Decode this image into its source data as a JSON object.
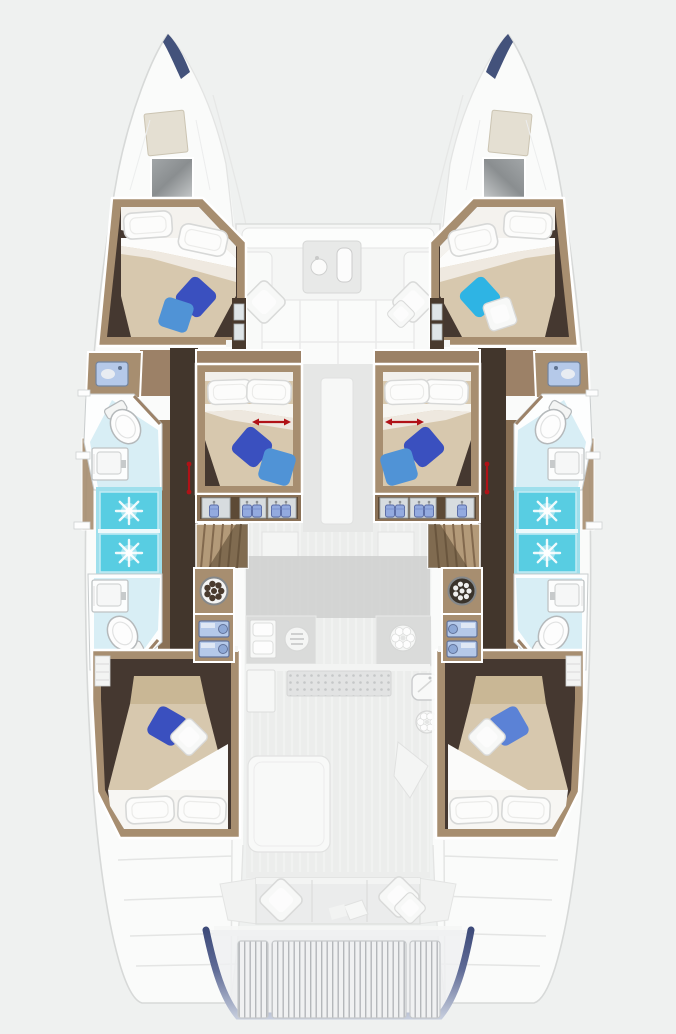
{
  "page": {
    "title": "Catamaran lower-deck floor plan",
    "background": "#eff1f0"
  },
  "colors": {
    "background": "#eff1f0",
    "hull-white": "#fbfcfb",
    "hull-outline": "#d7d9d8",
    "wood": "#a78e70",
    "wood-dark": "#8a7156",
    "cabin-floor": "#453830",
    "bed-duvet": "#d7c8ae",
    "bed-sheet": "#fcfcfb",
    "shower": "#58cde2",
    "shower-frame": "#9fdfec",
    "bath-floor": "#d8eef5",
    "fixture-white": "#fdfdfd",
    "arrow-red": "#b01217",
    "pillow-navy": "#3a50bf",
    "pillow-blue": "#5093d6",
    "pillow-cyan": "#2eb4e4",
    "pillow-periwinkle": "#5b82d6",
    "hanger-blue": "#93aadf",
    "appliance-blue": "#b5c9e9",
    "deck-faded": "#ebeceb",
    "deck-dark": "#d2d3d2",
    "counter-grey": "#dadbda",
    "bench-grey": "#ebecec",
    "transom-navy": "#3e4b7a",
    "hatch-grey": "#8a8e90",
    "hatch-beige": "#e4dfd2"
  },
  "vessel": {
    "type": "sailing-catamaran-floor-plan",
    "deck_shown": "lower-deck-highlighted-over-faded-main-deck",
    "cabins": [
      {
        "id": "port-forward-cabin",
        "features": [
          "double-bed",
          "two-white-pillows",
          "navy-accent-pillow",
          "blue-accent-pillow",
          "overhead-hatches"
        ]
      },
      {
        "id": "starboard-forward-cabin",
        "features": [
          "double-bed",
          "two-white-pillows",
          "cyan-accent-pillow",
          "white-accent-pillow",
          "overhead-hatches"
        ]
      },
      {
        "id": "port-center-cabin",
        "features": [
          "double-bed",
          "red-slide-arrow",
          "navy-accent-pillow",
          "blue-accent-pillow",
          "wardrobe-three-doors",
          "red-door-slide-arrow"
        ]
      },
      {
        "id": "starboard-center-cabin",
        "features": [
          "double-bed",
          "red-slide-arrow",
          "navy-accent-pillow",
          "blue-accent-pillow",
          "wardrobe-three-doors",
          "red-door-slide-arrow"
        ]
      },
      {
        "id": "port-aft-cabin",
        "features": [
          "double-bed",
          "two-white-pillows",
          "navy-accent-pillow",
          "white-accent-pillow",
          "shelf-unit"
        ]
      },
      {
        "id": "starboard-aft-cabin",
        "features": [
          "double-bed",
          "two-white-pillows",
          "periwinkle-accent-pillow",
          "white-accent-pillow",
          "shelf-unit"
        ]
      }
    ],
    "bathrooms": [
      {
        "id": "port-forward-bathroom",
        "fixtures": [
          "toilet",
          "washbasin",
          "shower-with-drain"
        ]
      },
      {
        "id": "port-aft-bathroom",
        "fixtures": [
          "washbasin",
          "toilet",
          "shower-with-drain"
        ]
      },
      {
        "id": "starboard-forward-bathroom",
        "fixtures": [
          "toilet",
          "washbasin",
          "shower-with-drain"
        ]
      },
      {
        "id": "starboard-aft-bathroom",
        "fixtures": [
          "washbasin",
          "toilet",
          "shower-with-drain"
        ]
      }
    ],
    "equipment": [
      "port-companionway-stairs",
      "starboard-companionway-stairs",
      "port-washing-machine",
      "starboard-washing-machine",
      "port-appliance-lockers",
      "starboard-appliance-lockers",
      "galley-double-sink",
      "galley-grill",
      "galley-burner",
      "forward-cockpit-lounge",
      "forward-cockpit-table",
      "aft-cockpit-bench",
      "aft-cockpit-cushions",
      "swim-platform-slats",
      "transom-band",
      "bow-anchor-hatch-port",
      "bow-anchor-hatch-starboard",
      "deck-hatch-port",
      "deck-hatch-starboard"
    ]
  }
}
